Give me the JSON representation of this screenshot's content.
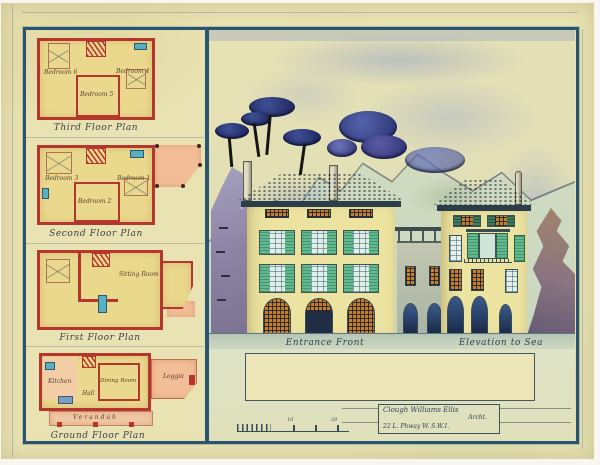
{
  "artwork": {
    "kind": "watercolour architectural drawing",
    "colors": {
      "paper": "#e9e2b2",
      "frame_blue": "#2a5570",
      "plan_wall_red": "#b5362c",
      "room_yellow": "#ead98d",
      "terrace_pink": "#f2bd97",
      "roof_teal": "#3f6c7e",
      "shutter_green": "#62bb8f",
      "lattice_orange": "#c9802e",
      "tree_blue": "#2f3d7a",
      "ink": "#2c4154"
    }
  },
  "plans": [
    {
      "caption": "Third Floor Plan",
      "rooms": [
        "Bedroom 6",
        "Bedroom 4",
        "Bedroom 5"
      ]
    },
    {
      "caption": "Second Floor Plan",
      "rooms": [
        "Bedroom 3",
        "Bedroom 1",
        "Bedroom 2"
      ]
    },
    {
      "caption": "First Floor Plan",
      "rooms": [
        "Sitting Room"
      ]
    },
    {
      "caption": "Ground Floor Plan",
      "rooms": [
        "Kitchen",
        "Hall",
        "Dining Room",
        "Loggia",
        "Verandah"
      ]
    }
  ],
  "elevations": [
    {
      "caption": "Entrance Front"
    },
    {
      "caption": "Elevation to Sea"
    }
  ],
  "scale_bar": {
    "labels": [
      "10",
      "20"
    ]
  },
  "title_block": {
    "line1": "Clough Williams Ellis",
    "line2": "Archt.",
    "line3": "22 L. Phway W. S.W.1."
  }
}
